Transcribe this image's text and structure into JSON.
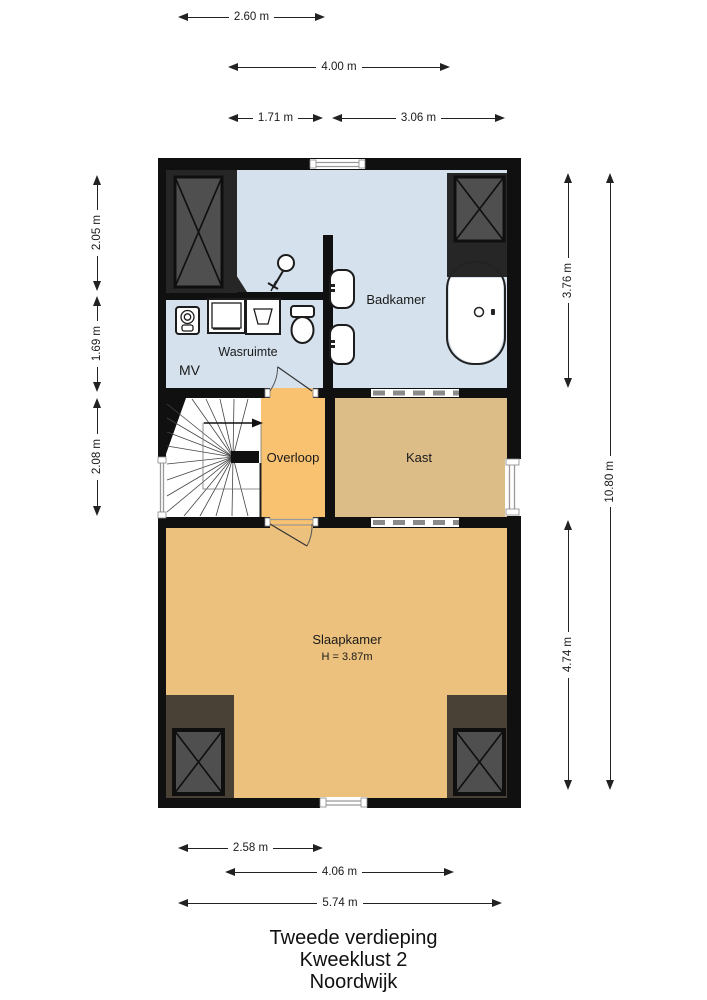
{
  "meta": {
    "floor_title": "Tweede verdieping",
    "property": "Kweeklust 2",
    "city": "Noordwijk"
  },
  "rooms": {
    "badkamer": {
      "label": "Badkamer"
    },
    "wasruimte": {
      "label": "Wasruimte"
    },
    "mv": {
      "label": "MV"
    },
    "overloop": {
      "label": "Overloop"
    },
    "kast": {
      "label": "Kast"
    },
    "slaapkamer": {
      "label": "Slaapkamer",
      "height_note": "H = 3.87m"
    }
  },
  "dimensions": {
    "top": [
      {
        "label": "2.60 m"
      },
      {
        "label": "4.00 m"
      },
      {
        "label": "1.71 m"
      },
      {
        "label": "3.06 m"
      }
    ],
    "bottom": [
      {
        "label": "2.58 m"
      },
      {
        "label": "4.06 m"
      },
      {
        "label": "5.74 m"
      }
    ],
    "left": [
      {
        "label": "2.05 m"
      },
      {
        "label": "1.69 m"
      },
      {
        "label": "2.08 m"
      }
    ],
    "right": [
      {
        "label": "3.76 m"
      },
      {
        "label": "4.74 m"
      },
      {
        "label": "10.80 m"
      }
    ]
  },
  "fixtures": [
    "stairs",
    "washing-machine",
    "laundry-sink",
    "mechanical-ventilation-unit",
    "toilet",
    "shower",
    "bathroom-sink",
    "bathroom-sink",
    "bathtub",
    "closet",
    "closet",
    "closet",
    "closet"
  ],
  "colors": {
    "wall": "#101010",
    "badkamer": "#D5E1ED",
    "overloop": "#F8C271",
    "kast": "#DCBD88",
    "slaapkamer": "#ECC17D",
    "closet_box": "#4F4F4F",
    "closet_dark": "#262626",
    "closet_brown": "#4A4136"
  }
}
